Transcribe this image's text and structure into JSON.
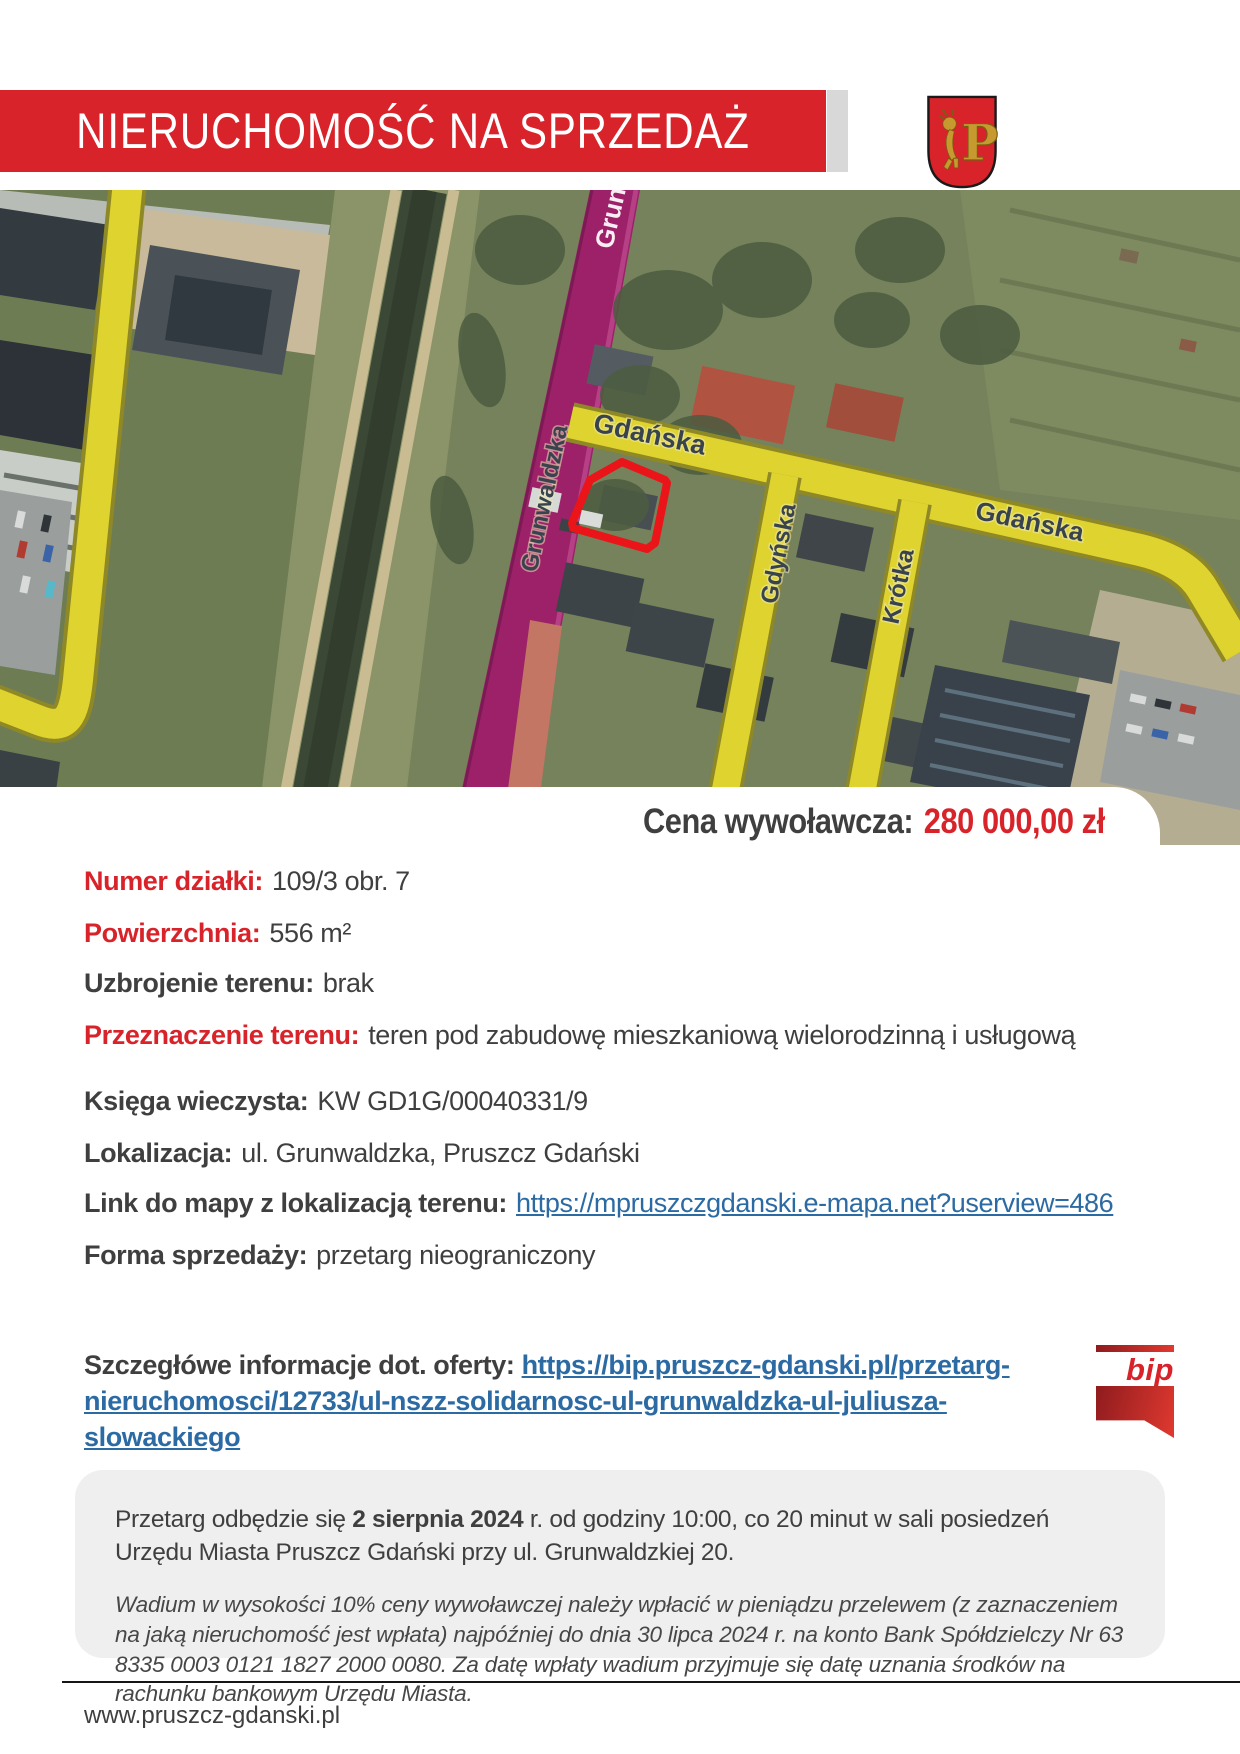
{
  "header": {
    "title": "NIERUCHOMOŚĆ NA SPRZEDAŻ"
  },
  "crest": {
    "letter": "P"
  },
  "map": {
    "streets": {
      "gdanska1": "Gdańska",
      "gdanska2": "Gdańska",
      "grunwaldzka": "Grunwaldzka",
      "gdynska": "Gdyńska",
      "krotka": "Krótka"
    },
    "watermark": "Grunwaldzka"
  },
  "price": {
    "label": "Cena wywoławcza:",
    "value": "280 000,00 zł"
  },
  "details": [
    {
      "label": "Numer działki:",
      "value": "109/3 obr. 7"
    },
    {
      "label": "Powierzchnia:",
      "value": "556 m²"
    },
    {
      "label": "Uzbrojenie terenu:",
      "value": "brak"
    },
    {
      "label": "Przeznaczenie terenu:",
      "value": "teren pod zabudowę mieszkaniową wielorodzinną i usługową"
    },
    {
      "label": "Księga wieczysta:",
      "value": "KW GD1G/00040331/9"
    },
    {
      "label": "Lokalizacja:",
      "value": "ul. Grunwaldzka, Pruszcz Gdański"
    },
    {
      "label": "Link do mapy z lokalizacją terenu:",
      "link": "https://mpruszczgdanski.e-mapa.net?userview=486"
    },
    {
      "label": "Forma sprzedaży:",
      "value": "przetarg nieograniczony"
    }
  ],
  "offer": {
    "label": "Szczegłówe informacje dot. oferty:",
    "link": "https://bip.pruszcz-gdanski.pl/przetarg-nieruchomosci/12733/ul-nszz-solidarnosc-ul-grunwaldzka-ul-juliusza-slowackiego"
  },
  "bip": {
    "label": "bip"
  },
  "notice": {
    "p1_before": "Przetarg odbędzie się ",
    "p1_bold": "2 sierpnia 2024",
    "p1_after": " r. od godziny 10:00, co 20 minut w sali posiedzeń Urzędu Miasta Pruszcz Gdański przy ul. Grunwaldzkiej 20.",
    "p2": "Wadium w wysokości 10% ceny wywoławczej należy wpłacić w pieniądzu przelewem (z zaznaczeniem na jaką nieruchomość jest wpłata) najpóźniej do dnia 30 lipca 2024 r. na konto Bank Spółdzielczy Nr 63 8335 0003 0121 1827 2000 0080. Za datę wpłaty wadium przyjmuje się datę uznania środków na rachunku bankowym Urzędu Miasta."
  },
  "footer": {
    "url": "www.pruszcz-gdanski.pl"
  },
  "colors": {
    "accent_red": "#d8232a",
    "link_blue": "#2b6aa3",
    "road_yellow": "#ded32f",
    "road_purple": "#9c2168",
    "parcel_red": "#ea1419"
  }
}
